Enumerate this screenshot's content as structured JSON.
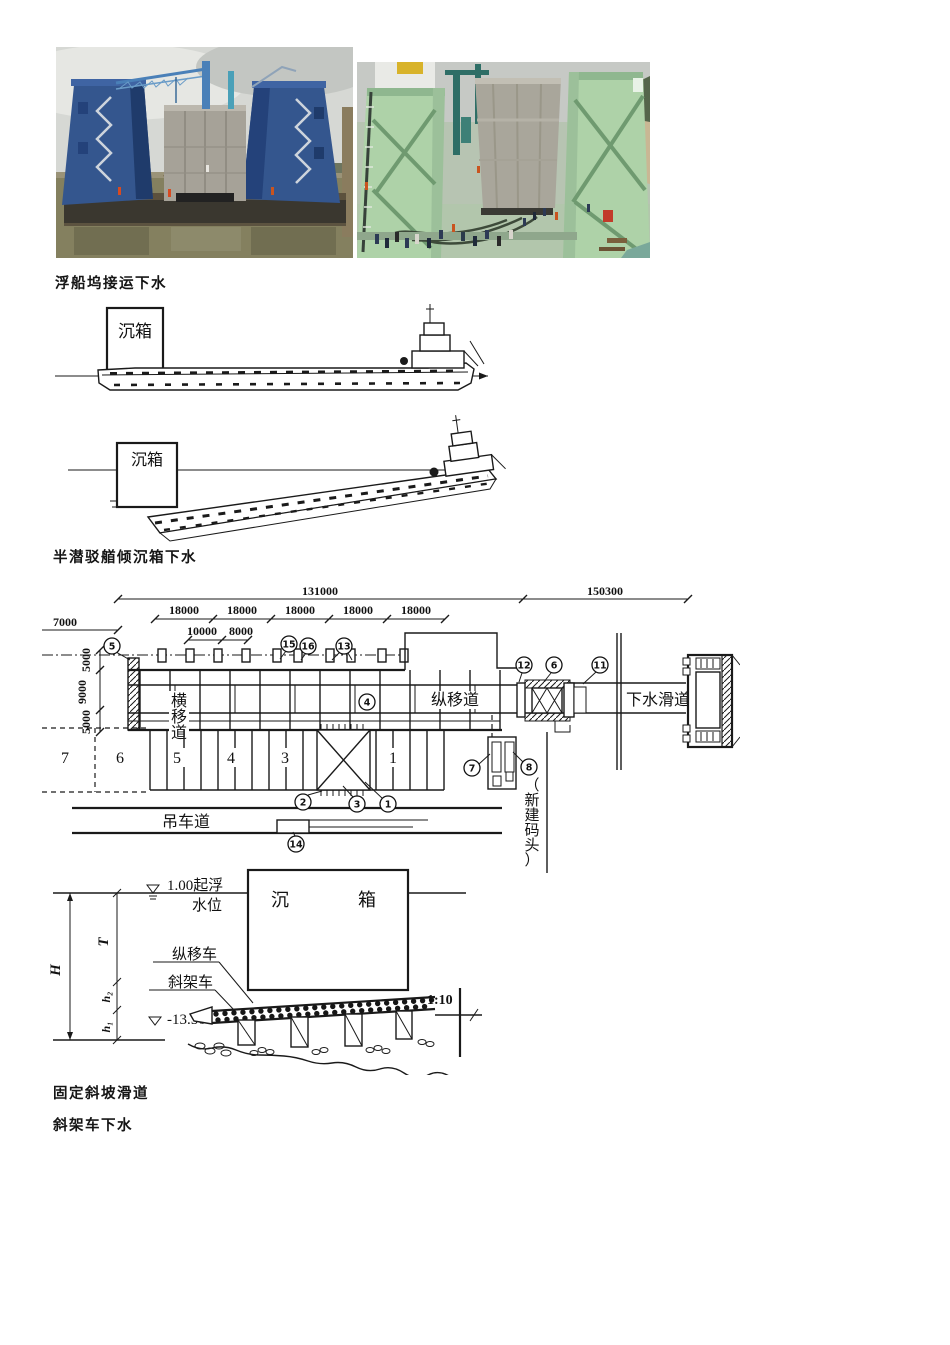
{
  "captions": {
    "floating_dock": "浮船坞接运下水",
    "semi_submersible": "半潜驳艏倾沉箱下水",
    "fixed_slope": "固定斜坡滑道",
    "tilt_frame": "斜架车下水"
  },
  "photos": {
    "left": {
      "description": "floating dock with two blue wing walls carrying a concrete caisson on water",
      "palette": {
        "sky": "#d6d8d4",
        "water": "#84805f",
        "dock_blue": "#34568e",
        "caisson": "#a6a298",
        "hull": "#3a372f"
      }
    },
    "right": {
      "description": "concrete caisson between two pale-green dock towers with workers on deck",
      "palette": {
        "sky": "#c6c9c5",
        "tower_green": "#aed2a8",
        "caisson": "#a9a69b",
        "deck": "#b2c6ac",
        "sand": "#c9b794"
      }
    }
  },
  "barge_figure": {
    "caisson_label": "沉箱"
  },
  "plan_figure": {
    "dims": {
      "total_left": "131000",
      "total_right": "150300",
      "bay": "18000",
      "left_offset": "7000",
      "sub1": "10000",
      "sub2": "8000",
      "v_top": "5000",
      "v_mid": "9000",
      "v_bot": "5000"
    },
    "labels": {
      "transverse_track": "横移道",
      "longitudinal_track": "纵移道",
      "launch_slipway": "下水滑道",
      "crane_track": "吊车道",
      "new_wharf": "（新建码头）"
    },
    "bays": [
      "7",
      "6",
      "5",
      "4",
      "3",
      "1"
    ],
    "markers": {
      "m1": "1",
      "m2": "2",
      "m3": "3",
      "m4": "4",
      "m5": "5",
      "m6": "6",
      "m7": "7",
      "m8": "8",
      "m11": "11",
      "m12": "12",
      "m13": "13",
      "m14": "14",
      "m15": "15",
      "m16": "16"
    }
  },
  "section_figure": {
    "water_level_top": "1.00起浮",
    "water_level_bottom": "水位",
    "caisson_char1": "沉",
    "caisson_char2": "箱",
    "long_car": "纵移车",
    "tilt_car": "斜架车",
    "bottom_level": "-13.50",
    "slope": "1:10",
    "dims": {
      "H": "H",
      "T": "T",
      "h1": "h₁",
      "h2": "h₂"
    }
  }
}
